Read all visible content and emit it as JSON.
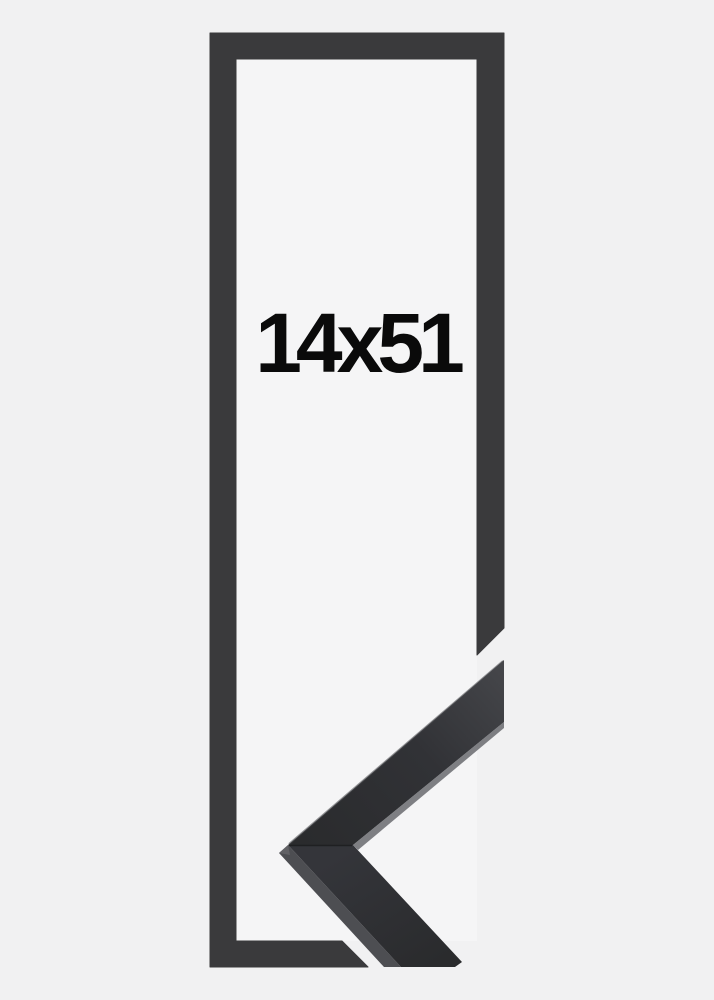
{
  "product": {
    "size_label": "14x51"
  },
  "colors": {
    "background": "#f1f1f2",
    "inner_background": "#f5f5f6",
    "frame_illustration": "#3a3a3c",
    "label_text": "#0a0a0a",
    "sample_face_dark": "#2a2b2d",
    "sample_face_mid": "#313236",
    "sample_face_light": "#46474b",
    "sample_bottom_face_top": "#34353a",
    "sample_bottom_face_end": "#2a2b2d",
    "sample_side": "#4d4e52",
    "sample_edge_highlight": "#696a6e",
    "sample_seam": "#1d1e20"
  }
}
